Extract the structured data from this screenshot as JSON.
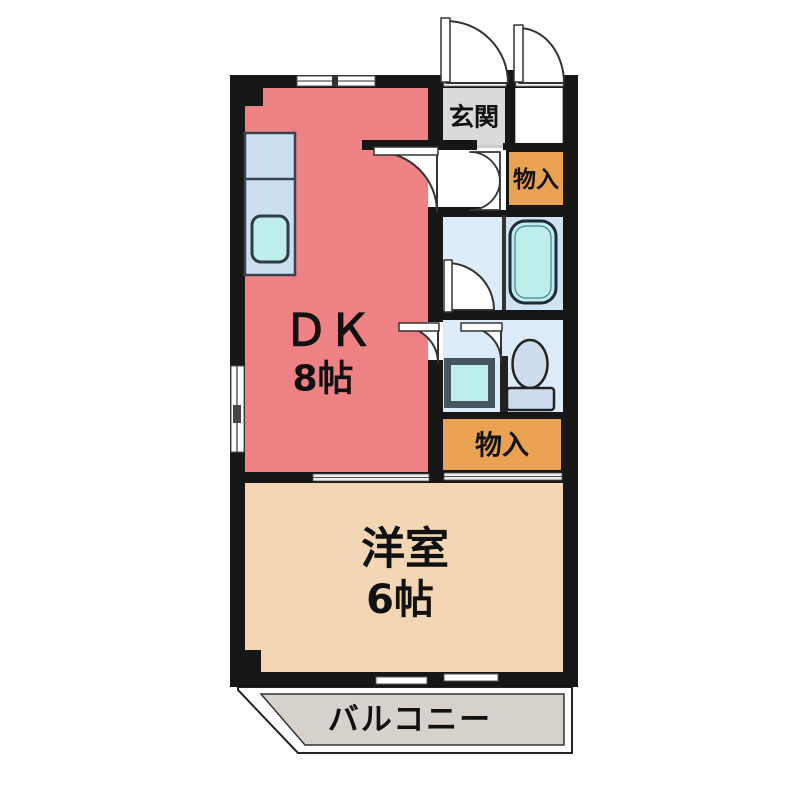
{
  "floor_plan": {
    "kind": "apartment-floor-plan",
    "rooms": {
      "dk": {
        "name": "ＤＫ",
        "size": "8帖"
      },
      "western_room": {
        "name": "洋室",
        "size": "6帖"
      },
      "entrance": {
        "name": "玄関"
      },
      "storage_top": {
        "name": "物入"
      },
      "storage_middle": {
        "name": "物入"
      },
      "balcony": {
        "name": "バルコニー"
      }
    },
    "fixtures": [
      "kitchen-counter",
      "kitchen-sink",
      "bathtub",
      "wash-basin",
      "toilet"
    ],
    "colors": {
      "wall": "#161616",
      "wall_soft": "#333333",
      "dk_pink": "#ee8183",
      "western_beige": "#f3d7b5",
      "storage_orange": "#e9a251",
      "entrance_gray": "#dadada",
      "balcony_gray": "#d6d2cb",
      "bath_blue": "#dcebf7",
      "tub_room_blue": "#cfe2f2",
      "counter_blue": "#ccdff0",
      "fixture_cyan": "#bdeeea",
      "toilet_blue": "#cfdcee",
      "door_white": "#ffffff"
    }
  }
}
